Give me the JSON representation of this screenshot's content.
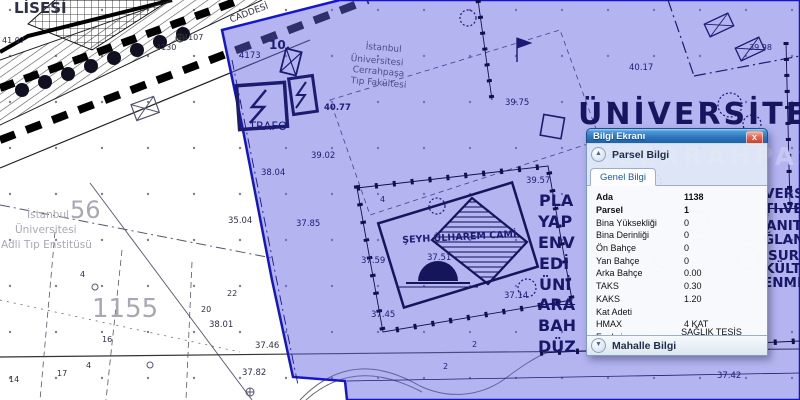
{
  "window": {
    "title": "Bilgi Ekranı",
    "close_glyph": "x",
    "parsel_section": "Parsel Bilgi",
    "mahalle_section": "Mahalle Bilgi",
    "tab": "Genel Bilgi",
    "collapse_glyph": "▲",
    "expand_glyph": "▼",
    "fields": [
      {
        "label": "Ada",
        "value": "1138"
      },
      {
        "label": "Parsel",
        "value": "1"
      },
      {
        "label": "Bina Yüksekliği",
        "value": "0"
      },
      {
        "label": "Bina Derinliği",
        "value": "0"
      },
      {
        "label": "Ön Bahçe",
        "value": "0"
      },
      {
        "label": "Yan Bahçe",
        "value": "0"
      },
      {
        "label": "Arka Bahçe",
        "value": "0.00"
      },
      {
        "label": "TAKS",
        "value": "0.30"
      },
      {
        "label": "KAKS",
        "value": "1.20"
      },
      {
        "label": "Kat Adeti",
        "value": ""
      },
      {
        "label": "HMAX",
        "value": "4 KAT"
      },
      {
        "label": "Fonksiyon",
        "value": "SAĞLIK TESİS ALANI"
      }
    ]
  },
  "map": {
    "overlay_color": "#6262e1",
    "overlay_border": "#1515cd",
    "line_navy": "#1b1b70",
    "labels": [
      {
        "t": "LİSESİ",
        "x": 14,
        "y": 1,
        "s": 15,
        "c": "c-d",
        "b": 1
      },
      {
        "t": "CADDESİ",
        "x": 229,
        "y": 17,
        "s": 9,
        "c": "c-d",
        "r": -21
      },
      {
        "t": "41.07",
        "x": 2,
        "y": 37,
        "s": 8,
        "c": "c-d"
      },
      {
        "t": "4107",
        "x": 183,
        "y": 34,
        "s": 8,
        "c": "c-d"
      },
      {
        "t": "4130",
        "x": 156,
        "y": 44,
        "s": 8,
        "c": "c-d"
      },
      {
        "t": "4173",
        "x": 239,
        "y": 52,
        "s": 8.5,
        "c": "c-n"
      },
      {
        "t": "10.",
        "x": 269,
        "y": 39,
        "s": 12,
        "c": "c-n",
        "b": 1
      },
      {
        "t": "TRAFO",
        "x": 249,
        "y": 121,
        "s": 11.5,
        "c": "c-n"
      },
      {
        "t": "İstanbul",
        "x": 366,
        "y": 43,
        "s": 9,
        "c": "c-soft",
        "r": 5
      },
      {
        "t": "Üniversitesi",
        "x": 351,
        "y": 55,
        "s": 9,
        "c": "c-soft",
        "r": 5
      },
      {
        "t": "Cerrahpaşa",
        "x": 353,
        "y": 66,
        "s": 9,
        "c": "c-soft",
        "r": 5
      },
      {
        "t": "Tıp Fakültesi",
        "x": 351,
        "y": 77,
        "s": 9,
        "c": "c-soft",
        "r": 5
      },
      {
        "t": "40.77",
        "x": 324,
        "y": 104,
        "s": 8.5,
        "c": "c-n",
        "b": 1
      },
      {
        "t": "39.75",
        "x": 505,
        "y": 99,
        "s": 8.5,
        "c": "c-n"
      },
      {
        "t": "40.17",
        "x": 629,
        "y": 64,
        "s": 8.5,
        "c": "c-n"
      },
      {
        "t": "39.98",
        "x": 749,
        "y": 44,
        "s": 8,
        "c": "c-n"
      },
      {
        "t": "39.57",
        "x": 526,
        "y": 177,
        "s": 8.5,
        "c": "c-n"
      },
      {
        "t": "ŞEYH ÜLHAREM CAMİ",
        "x": 402,
        "y": 236,
        "s": 9.5,
        "c": "c-n",
        "b": 1,
        "r": -3
      },
      {
        "t": "37.51",
        "x": 427,
        "y": 254,
        "s": 8.5,
        "c": "c-n"
      },
      {
        "t": "37.59",
        "x": 361,
        "y": 257,
        "s": 8.5,
        "c": "c-n"
      },
      {
        "t": "37.14",
        "x": 504,
        "y": 292,
        "s": 8.5,
        "c": "c-n"
      },
      {
        "t": "37.45",
        "x": 371,
        "y": 311,
        "s": 8.5,
        "c": "c-n"
      },
      {
        "t": "37.85",
        "x": 296,
        "y": 220,
        "s": 8.5,
        "c": "c-n"
      },
      {
        "t": "38.04",
        "x": 261,
        "y": 169,
        "s": 8.5,
        "c": "c-n"
      },
      {
        "t": "39.02",
        "x": 311,
        "y": 152,
        "s": 8.5,
        "c": "c-n"
      },
      {
        "t": "4",
        "x": 380,
        "y": 196,
        "s": 8,
        "c": "c-n"
      },
      {
        "t": "2",
        "x": 472,
        "y": 341,
        "s": 8,
        "c": "c-n"
      },
      {
        "t": "2",
        "x": 443,
        "y": 363,
        "s": 8,
        "c": "c-n"
      },
      {
        "t": "37.42",
        "x": 717,
        "y": 372,
        "s": 8.5,
        "c": "c-n"
      },
      {
        "t": "35.04",
        "x": 228,
        "y": 217,
        "s": 8.5,
        "c": "c-d"
      },
      {
        "t": "38.01",
        "x": 209,
        "y": 321,
        "s": 8.5,
        "c": "c-d"
      },
      {
        "t": "37.46",
        "x": 255,
        "y": 342,
        "s": 8.5,
        "c": "c-d"
      },
      {
        "t": "37.82",
        "x": 242,
        "y": 369,
        "s": 8.5,
        "c": "c-d"
      },
      {
        "t": "56",
        "x": 70,
        "y": 198,
        "s": 24,
        "c": "c-g"
      },
      {
        "t": "1155",
        "x": 92,
        "y": 296,
        "s": 26,
        "c": "c-g"
      },
      {
        "t": "İstanbul",
        "x": 27,
        "y": 210,
        "s": 10.5,
        "c": "c-g"
      },
      {
        "t": "Üniversitesi",
        "x": 15,
        "y": 225,
        "s": 10.5,
        "c": "c-g"
      },
      {
        "t": "Adli Tıp Enstitüsü",
        "x": 1,
        "y": 240,
        "s": 10.5,
        "c": "c-g"
      },
      {
        "t": "4",
        "x": 80,
        "y": 271,
        "s": 8,
        "c": "c-d"
      },
      {
        "t": "22",
        "x": 227,
        "y": 290,
        "s": 8,
        "c": "c-d"
      },
      {
        "t": "20",
        "x": 201,
        "y": 306,
        "s": 8,
        "c": "c-d"
      },
      {
        "t": "16",
        "x": 102,
        "y": 336,
        "s": 8,
        "c": "c-d"
      },
      {
        "t": "4",
        "x": 86,
        "y": 362,
        "s": 8,
        "c": "c-d"
      },
      {
        "t": "17",
        "x": 57,
        "y": 370,
        "s": 8,
        "c": "c-d"
      },
      {
        "t": "14",
        "x": 9,
        "y": 376,
        "s": 8,
        "c": "c-d"
      },
      {
        "t": "ÜNİVERSİTE SA",
        "x": 578,
        "y": 100,
        "s": 30,
        "c": "c-big"
      },
      {
        "t": "(CERRAHPAŞA",
        "x": 601,
        "y": 144,
        "s": 25,
        "c": "c-cerrah"
      },
      {
        "t": "ĞİTE HASTANELER",
        "x": 592,
        "y": 249,
        "s": 13,
        "c": "c-faint"
      },
      {
        "t": "MA, HASTANELERİ",
        "x": 592,
        "y": 270,
        "s": 13,
        "c": "c-faint"
      },
      {
        "t": "LERİ, PARK VE DİNL",
        "x": 592,
        "y": 291,
        "s": 13,
        "c": "c-faint"
      },
      {
        "t": "ENENECEKTİR",
        "x": 592,
        "y": 310,
        "s": 13,
        "c": "c-faint"
      },
      {
        "t": "PLA",
        "x": 539,
        "y": 193,
        "s": 16,
        "c": "c-frag"
      },
      {
        "t": "YAP",
        "x": 538,
        "y": 214,
        "s": 16,
        "c": "c-frag"
      },
      {
        "t": "ENV",
        "x": 538,
        "y": 235,
        "s": 16,
        "c": "c-frag"
      },
      {
        "t": "EDİ",
        "x": 539,
        "y": 256,
        "s": 16,
        "c": "c-frag"
      },
      {
        "t": "ÜNİ",
        "x": 539,
        "y": 277,
        "s": 16,
        "c": "c-frag"
      },
      {
        "t": "ARA",
        "x": 538,
        "y": 297,
        "s": 16,
        "c": "c-frag",
        "k": 1
      },
      {
        "t": "BAH",
        "x": 538,
        "y": 318,
        "s": 16,
        "c": "c-frag"
      },
      {
        "t": "DÜZ",
        "x": 538,
        "y": 339,
        "s": 16,
        "c": "c-frag"
      },
      {
        "t": "VERS",
        "x": 764,
        "y": 188,
        "s": 13.5,
        "c": "c-frag"
      },
      {
        "t": "TI VE",
        "x": 764,
        "y": 203,
        "s": 13.5,
        "c": "c-frag",
        "k": 1
      },
      {
        "t": "ANIT",
        "x": 766,
        "y": 220,
        "s": 13.5,
        "c": "c-frag"
      },
      {
        "t": "ĞLAN",
        "x": 763,
        "y": 234,
        "s": 13.5,
        "c": "c-frag"
      },
      {
        "t": "SUR",
        "x": 768,
        "y": 250,
        "s": 13.5,
        "c": "c-frag"
      },
      {
        "t": "KÜLT",
        "x": 764,
        "y": 263,
        "s": 13.5,
        "c": "c-frag"
      },
      {
        "t": "ENME",
        "x": 763,
        "y": 277,
        "s": 13.5,
        "c": "c-frag"
      }
    ]
  }
}
